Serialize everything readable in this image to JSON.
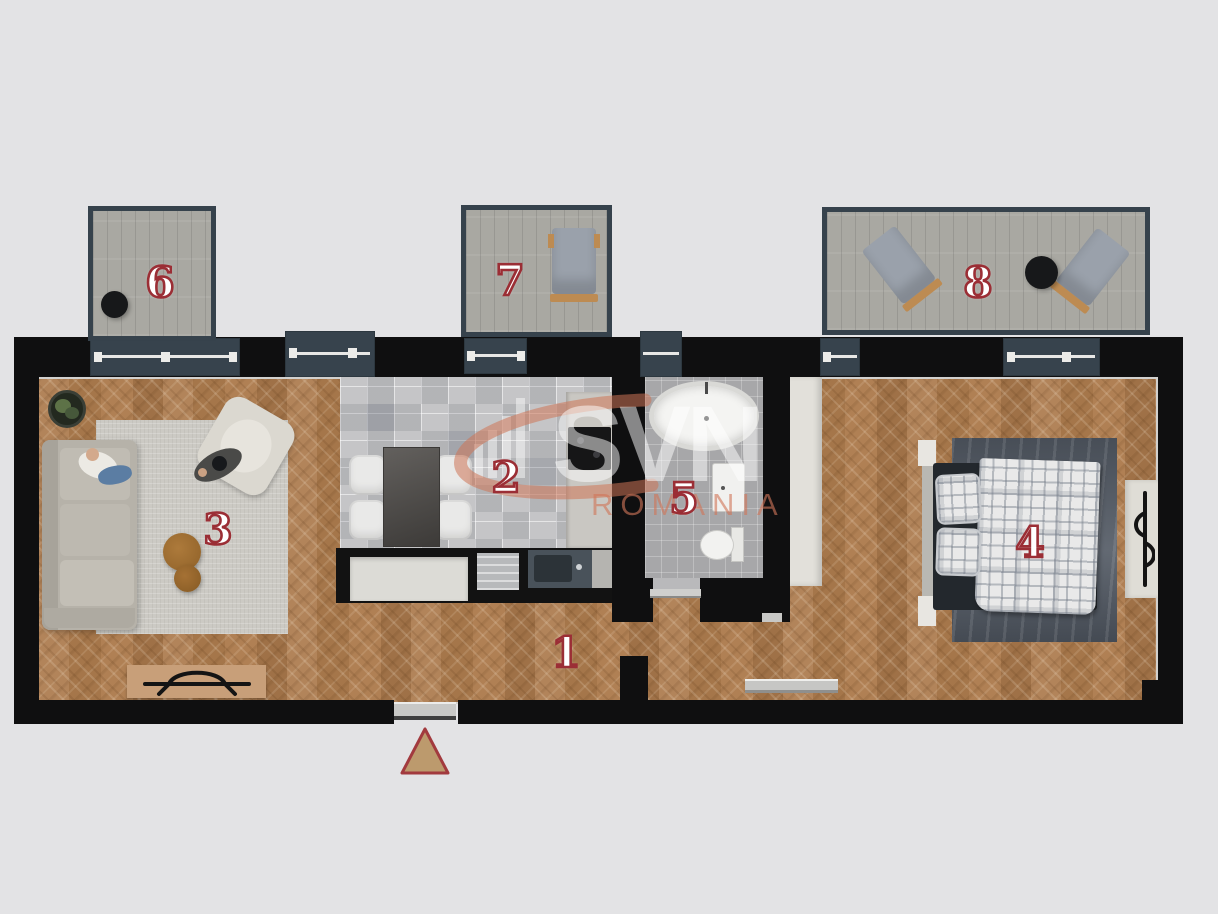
{
  "canvas": {
    "background": "#e3e3e5"
  },
  "palette": {
    "wall": "#0f0f10",
    "window_slate": "#37434d",
    "window_frame_white": "#e8e8e6",
    "wood_floor": "#ab7c4c",
    "balcony_floor": "#a9a8a2",
    "kitchen_tile": "#c5c5c7",
    "bath_tile": "#a7a7a9",
    "accent_red": "#9b2e35",
    "triangle_fill": "#bc9a6d",
    "triangle_border": "#a23a3e",
    "watermark_coral": "#cd7456"
  },
  "rooms": [
    {
      "label": "1",
      "name": "hallway"
    },
    {
      "label": "2",
      "name": "kitchen"
    },
    {
      "label": "3",
      "name": "living-room"
    },
    {
      "label": "4",
      "name": "bedroom"
    },
    {
      "label": "5",
      "name": "bathroom"
    },
    {
      "label": "6",
      "name": "balcony-left"
    },
    {
      "label": "7",
      "name": "balcony-middle"
    },
    {
      "label": "8",
      "name": "terrace-right"
    }
  ],
  "watermark": {
    "logo": "SVN",
    "subtitle": "ROMANIA"
  }
}
